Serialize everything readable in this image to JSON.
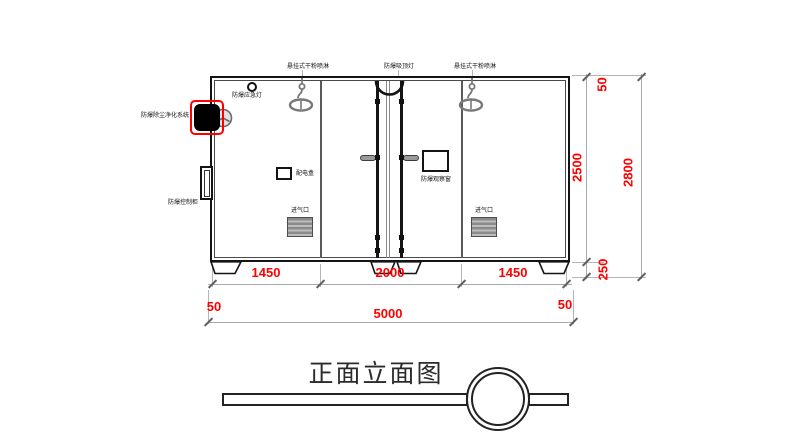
{
  "title": {
    "text": "正面立面图"
  },
  "equipment_labels": {
    "sprinkler_left": "悬挂式干粉喷淋",
    "ceiling_light": "防爆吸顶灯",
    "sprinkler_right": "悬挂式干粉喷淋",
    "emergency_light": "防爆应急灯",
    "dust_purification_system": "防爆除尘净化系统",
    "control_cabinet": "防爆控制柜",
    "distribution_box": "配电盒",
    "observation_window": "防爆观察窗",
    "air_inlet_left": "进气口",
    "air_inlet_right": "进气口"
  },
  "dimensions": {
    "bottom_segments": [
      "1450",
      "2000",
      "1450"
    ],
    "bottom_offset_left": "50",
    "bottom_total": "5000",
    "bottom_offset_right": "50",
    "side_top_offset": "50",
    "side_body_height": "2500",
    "side_base_height": "250",
    "side_total_height": "2800"
  },
  "colors": {
    "dimension_text": "#ff0000",
    "highlight_box": "#ff0000",
    "drawing_line": "#1a1a1a",
    "detail_gray": "#787878"
  }
}
